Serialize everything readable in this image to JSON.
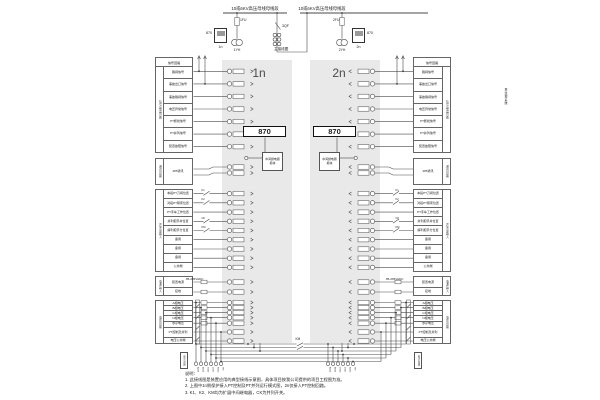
{
  "top": {
    "bus_title_left": "10或6KV高压母线母线段",
    "bus_title_right": "10或6KV高压母线母线段",
    "main_wiring_label": "主接线图",
    "breaker": "3QF",
    "left_device": {
      "label": "870",
      "id": "1n",
      "fuse": "1FU",
      "pt": "1YH"
    },
    "right_device": {
      "label": "870",
      "id": "2n",
      "fuse": "2FU",
      "pt": "2YH"
    }
  },
  "panels": {
    "left_id": "1n",
    "right_id": "2n",
    "left_module": "870",
    "right_module": "870",
    "left_relay_module": "中间继电器模块",
    "right_relay_module": "中间继电器模块",
    "fill": "#e9e9e9"
  },
  "tables": {
    "signal": {
      "header": "信号回路",
      "side": "信号输出回路",
      "rows": [
        "跳闸信号",
        "事故出口信号",
        "事故跳闸信号",
        "电压异常信号",
        "PT断线信号",
        "PT并列信号",
        "装置故障信号"
      ]
    },
    "comm": {
      "side": "通讯回路",
      "rows": [
        "485通讯"
      ]
    },
    "di": {
      "side": "开关量输入",
      "rows": [
        "本段PT刀闸位置",
        "对段PT隔离位置",
        "PT手车工作位置",
        "并列把手并位置",
        "解列把手分位置",
        "备用",
        "备用",
        "备用",
        "公共端"
      ]
    },
    "power": {
      "side": "电源输入",
      "rows": [
        "装置电源",
        "接地"
      ],
      "range": "85-265VADC"
    },
    "voltage": {
      "side": "电压回路",
      "rows": [
        "A相电压",
        "B相电压",
        "C相电压",
        "N相电压",
        "零序电压",
        "PT控制及并列",
        "电压公共端"
      ]
    }
  },
  "contacts": {
    "labels": [
      "K1",
      "K2",
      "CK",
      "KM"
    ]
  },
  "bottom": {
    "km_label": "KM",
    "bus_tag_left": "电压小母线",
    "bus_tag_right": "电压小母线",
    "terminal_labels": [
      "A630",
      "B630",
      "C630",
      "L630",
      "N600",
      "YM"
    ]
  },
  "annotations": {
    "right_side_vertical": "至监控系统"
  },
  "notes": {
    "title": "说明：",
    "items": [
      "1. 此接线图是装置应用的典型接线示意图，具体项目按我公司提供的项目工程图为准。",
      "2. 上图中1n侧保护接入PT控制及PT并列运行模式图，2n仅接入PT控制回路。",
      "3. K1、K2、KM均为扩展中间继电器，CK为并列开关。"
    ]
  }
}
